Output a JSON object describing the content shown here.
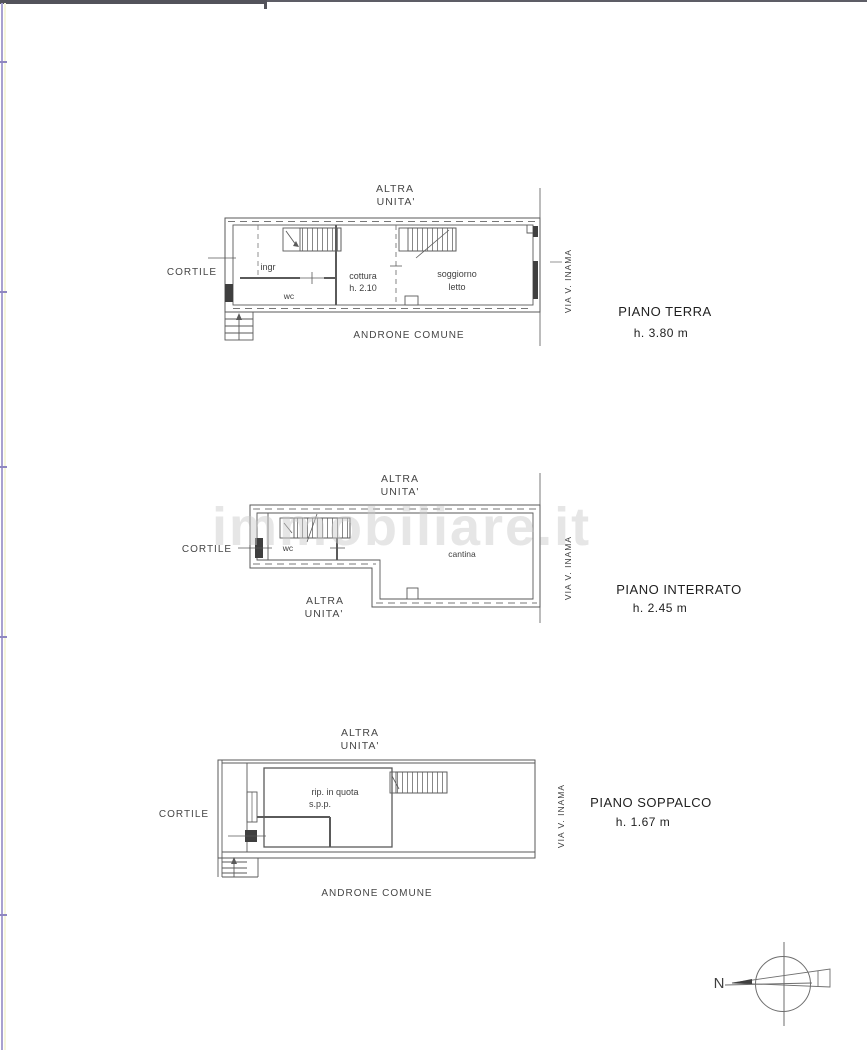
{
  "palette": {
    "wall_line": "#5a5a5a",
    "dark_fitting": "#3f3f3f",
    "watermark": "#c8c8c8",
    "top_bar": "#53535b",
    "page_edge": "#a8a1d0"
  },
  "watermark": {
    "text": "immobiliare.it"
  },
  "floors": [
    {
      "title": "PIANO TERRA",
      "height": "h. 3.80 m",
      "surroundings": {
        "top_line1": "ALTRA",
        "top_line2": "UNITA'",
        "left": "CORTILE",
        "street": "VIA V. INAMA",
        "bottom": "ANDRONE COMUNE"
      },
      "rooms": {
        "ingresso": "ingr",
        "wc": "wc",
        "cottura_line1": "cottura",
        "cottura_line2": "h. 2.10",
        "soggiorno_line1": "soggiorno",
        "soggiorno_line2": "letto"
      }
    },
    {
      "title": "PIANO INTERRATO",
      "height": "h. 2.45 m",
      "surroundings": {
        "top_line1": "ALTRA",
        "top_line2": "UNITA'",
        "left": "CORTILE",
        "street": "VIA V. INAMA",
        "bottom_left_line1": "ALTRA",
        "bottom_left_line2": "UNITA'"
      },
      "rooms": {
        "wc": "wc",
        "cantina": "cantina"
      }
    },
    {
      "title": "PIANO SOPPALCO",
      "height": "h. 1.67 m",
      "surroundings": {
        "top_line1": "ALTRA",
        "top_line2": "UNITA'",
        "left": "CORTILE",
        "street": "VIA V. INAMA",
        "bottom": "ANDRONE COMUNE"
      },
      "rooms": {
        "rip_line1": "rip. in quota",
        "rip_line2": "s.p.p."
      }
    }
  ],
  "compass": {
    "north": "N"
  }
}
